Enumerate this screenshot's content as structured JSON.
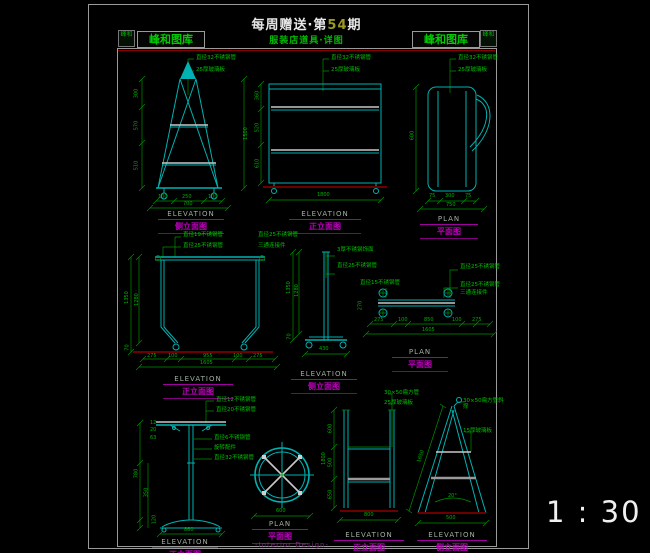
{
  "header": {
    "title_prefix": "每周赠送·第",
    "title_issue": "54",
    "title_suffix": "期",
    "subtitle": "服装店道具·详图",
    "logo_text_left": "峰和图库",
    "logo_text_right": "峰和图库",
    "logo_icon_text": "峰和"
  },
  "footer": {
    "signature": "-Interior Design-",
    "scale": "1 : 30"
  },
  "colors": {
    "line_cyan": "#00b2b2",
    "text_green": "#00c000",
    "caption_magenta": "#c000c0",
    "ground_red": "#6a0000",
    "title_white": "#e8e8e8",
    "issue_olive": "#9a9a22"
  },
  "drawings": [
    {
      "caption_en": "ELEVATION",
      "caption_cn": "侧立面图",
      "labels": [
        "直径32不锈钢管",
        "25厚玻璃板"
      ],
      "dims": {
        "left": [
          "300",
          "570",
          "510"
        ],
        "right_total": "1500",
        "bottom": [
          "100",
          "250",
          "100"
        ],
        "bottom_total": "700"
      }
    },
    {
      "caption_en": "ELEVATION",
      "caption_cn": "正立面图",
      "labels": [
        "直径32不锈钢管",
        "25厚玻璃板"
      ],
      "dims": {
        "left": [
          "360",
          "520",
          "610"
        ],
        "bottom_total": "1800"
      }
    },
    {
      "caption_en": "PLAN",
      "caption_cn": "平面图",
      "labels": [
        "直径32不锈钢管",
        "25厚玻璃板"
      ],
      "dims": {
        "left_total": "600",
        "bottom": [
          "75",
          "300",
          "75"
        ],
        "bottom_total": "750"
      }
    },
    {
      "caption_en": "ELEVATION",
      "caption_cn": "正立面图",
      "labels": [
        "直径19不锈钢管",
        "直径25不锈钢管",
        "直径25不锈钢管",
        "三通连接件"
      ],
      "dims": {
        "left": [
          "1350",
          "1280",
          "70"
        ],
        "bottom": [
          "275",
          "100",
          "955",
          "100",
          "275"
        ],
        "bottom_total": "1605"
      }
    },
    {
      "caption_en": "ELEVATION",
      "caption_cn": "侧立面图",
      "labels": [
        "3厚不锈钢饰面",
        "直径25不锈钢管"
      ],
      "dims": {
        "left": [
          "1350",
          "1280",
          "70"
        ],
        "bottom_total": "430"
      }
    },
    {
      "caption_en": "PLAN",
      "caption_cn": "平面图",
      "labels": [
        "直径15不锈钢管",
        "直径25不锈钢管",
        "直径25不锈钢管",
        "三通连接件"
      ],
      "dims": {
        "left": "270",
        "bottom": [
          "275",
          "100",
          "850",
          "100",
          "275"
        ],
        "bottom_total": "1605"
      }
    },
    {
      "caption_en": "ELEVATION",
      "caption_cn": "正立面图",
      "labels": [
        "直径12不锈钢管",
        "直径20不锈钢管",
        "直径6不锈钢管",
        "旋转配件",
        "直径32不锈钢管"
      ],
      "dims": {
        "left_small": [
          "12",
          "20",
          "63"
        ],
        "left": [
          "780",
          "350",
          "120"
        ],
        "bottom_total": "860"
      }
    },
    {
      "caption_en": "PLAN",
      "caption_cn": "平面图",
      "labels": [],
      "dims": {
        "bottom_total": "600"
      }
    },
    {
      "caption_en": "ELEVATION",
      "caption_cn": "正立面图",
      "labels": [
        "30×50扁方管",
        "25厚玻璃板"
      ],
      "dims": {
        "left": [
          "600",
          "500",
          "650"
        ],
        "left_total": "1800",
        "bottom_total": "800"
      }
    },
    {
      "caption_en": "ELEVATION",
      "caption_cn": "侧立面图",
      "labels": [
        "30×50扁方管斜撑",
        "15厚玻璃板"
      ],
      "dims": {
        "slant": "1650",
        "angle": "20°",
        "bottom_total": "500"
      }
    }
  ]
}
